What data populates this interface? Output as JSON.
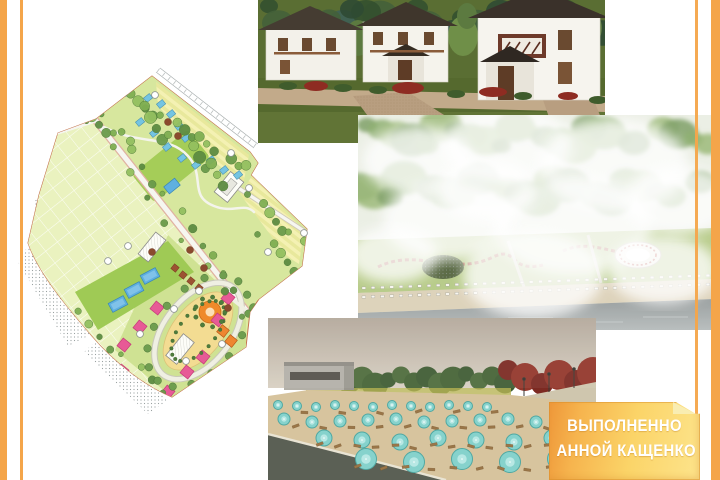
{
  "badge": {
    "line1": "ВЫПОЛНЕННО",
    "line2": "АННОЙ КАЩЕНКО"
  },
  "theme": {
    "page_bg": "#ffffff",
    "stripe_color": "#f4a54a",
    "badge_outer": "#ee9739",
    "badge_inner": "#fbd468",
    "badge_text": "#ffffff",
    "plan_base_green": "#dceba2",
    "plan_park_green": "#d7e79e",
    "plan_plots_green": "#eaf2bf",
    "plan_lawn_green": "#a2cb57",
    "plan_building_pink": "#e75a96",
    "plan_building_orange": "#ee8630",
    "plan_pool_blue": "#5fb0e0",
    "plan_cottage_blue": "#74c4e2",
    "umbrella_turquoise": "#86d2cc",
    "sand_tan": "#d7c49e",
    "boundary_red": "#c4724e"
  }
}
